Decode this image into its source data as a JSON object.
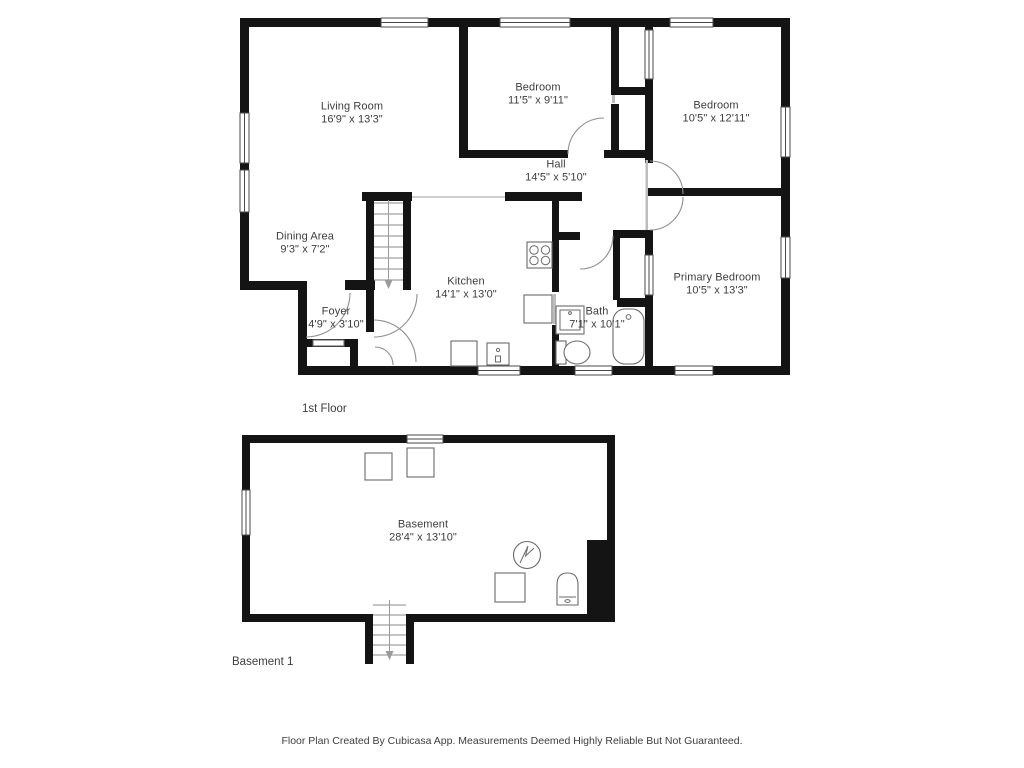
{
  "page": {
    "footer": "Floor Plan Created By Cubicasa App. Measurements Deemed Highly Reliable But Not Guaranteed."
  },
  "colors": {
    "wall": "#141414",
    "fixture_outline": "#6a6a6a",
    "door_arc": "#8f8f8f",
    "text": "#3d3d3d",
    "background": "#ffffff"
  },
  "floors": [
    {
      "title": "1st Floor",
      "rooms": [
        {
          "name": "Living Room",
          "dims": "16'9\" x 13'3\""
        },
        {
          "name": "Bedroom",
          "dims": "11'5\" x 9'11\""
        },
        {
          "name": "Bedroom",
          "dims": "10'5\" x 12'11\""
        },
        {
          "name": "Hall",
          "dims": "14'5\" x 5'10\""
        },
        {
          "name": "Dining Area",
          "dims": "9'3\" x 7'2\""
        },
        {
          "name": "Kitchen",
          "dims": "14'1\" x 13'0\""
        },
        {
          "name": "Foyer",
          "dims": "4'9\" x 3'10\""
        },
        {
          "name": "Bath",
          "dims": "7'1\" x 10'1\""
        },
        {
          "name": "Primary Bedroom",
          "dims": "10'5\" x 13'3\""
        }
      ]
    },
    {
      "title": "Basement 1",
      "rooms": [
        {
          "name": "Basement",
          "dims": "28'4\" x 13'10\""
        }
      ]
    }
  ]
}
